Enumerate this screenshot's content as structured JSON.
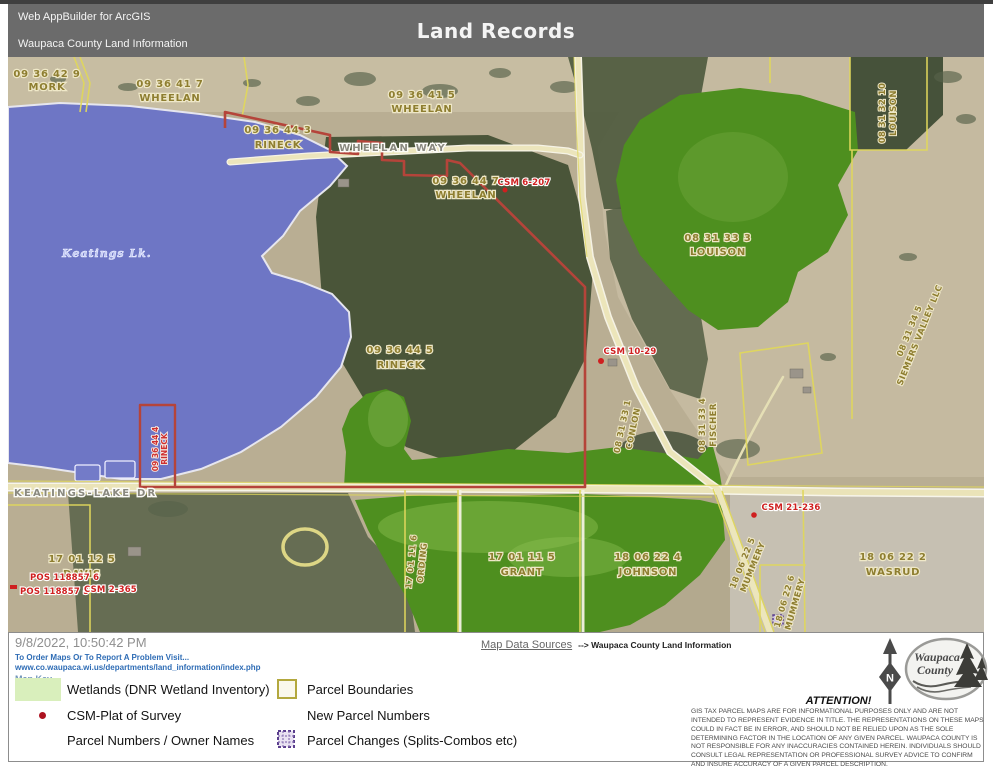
{
  "header": {
    "app": "Web AppBuilder for ArcGIS",
    "org": "Waupaca County Land Information",
    "title": "Land Records"
  },
  "map": {
    "lake_label": "Keatings Lk.",
    "roads": {
      "wheelan_way": "WHEELAN WAY",
      "keatings_lake_dr": "KEATINGS-LAKE DR"
    },
    "parcels": {
      "mork": {
        "id": "09 36 42 9",
        "name": "MORK"
      },
      "wheelan7": {
        "id": "09 36 41 7",
        "name": "WHEELAN"
      },
      "wheelan5": {
        "id": "09 36 41 5",
        "name": "WHEELAN"
      },
      "rineck3": {
        "id": "09 36 44 3",
        "name": "RINECK"
      },
      "wheelan447": {
        "id": "09 36 44 7",
        "name": "WHEELAN"
      },
      "louison33": {
        "id": "08 31 33 3",
        "name": "LOUISON"
      },
      "louison32": {
        "id": "08 31 32 10",
        "name": "LOUISON"
      },
      "siemers": {
        "id": "08 31 34 5",
        "name": "SIEMERS VALLEY LLC"
      },
      "rineck5": {
        "id": "09 36 44 5",
        "name": "RINECK"
      },
      "conlon": {
        "id": "08 31 33 1",
        "name": "CONLON"
      },
      "fischer": {
        "id": "08 31 33 4",
        "name": "FISCHER"
      },
      "rineck4": {
        "id": "09 36 44 4",
        "name": "RINECK"
      },
      "davis": {
        "id": "17 01 12 5",
        "name": "DAVIS"
      },
      "ording": {
        "id": "17 01 11 6",
        "name": "ORDING"
      },
      "grant": {
        "id": "17 01 11 5",
        "name": "GRANT"
      },
      "johnson": {
        "id": "18 06 22 4",
        "name": "JOHNSON"
      },
      "mummery5": {
        "id": "18 06 22 5",
        "name": "MUMMERY"
      },
      "mummery6": {
        "id": "18 06 22 6",
        "name": "MUMMERY"
      },
      "wasrud": {
        "id": "18 06 22 2",
        "name": "WASRUD"
      }
    },
    "surveys": {
      "csm6207": "CSM 6-207",
      "csm1029": "CSM 10-29",
      "csm21236": "CSM 21-236",
      "pos6": "POS 118857 6",
      "pos5": "POS 118857 5",
      "csm2365": "CSM 2-365"
    }
  },
  "footer": {
    "timestamp": "9/8/2022, 10:50:42 PM",
    "order_line1": "To Order Maps Or To Report A Problem Visit...",
    "order_line2": "www.co.waupaca.wi.us/departments/land_information/index.php",
    "map_key_label": "Map Key",
    "legend": {
      "wetlands": "Wetlands (DNR Wetland Inventory)",
      "parcel_boundaries": "Parcel Boundaries",
      "csm_plat": "CSM-Plat of Survey",
      "new_parcel_numbers": "New Parcel Numbers",
      "parcel_numbers": "Parcel Numbers / Owner Names",
      "parcel_changes": "Parcel Changes (Splits-Combos etc)"
    },
    "data_sources_label": "Map Data Sources",
    "data_sources_value": "--> Waupaca County Land Information",
    "attention_title": "ATTENTION!",
    "attention_text": "GIS TAX PARCEL MAPS ARE FOR INFORMATIONAL PURPOSES ONLY AND ARE NOT INTENDED TO REPRESENT EVIDENCE IN TITLE. THE REPRESENTATIONS ON THESE MAPS COULD IN FACT BE IN ERROR, AND SHOULD NOT BE RELIED UPON AS THE SOLE DETERMINING FACTOR IN THE LOCATION OF ANY GIVEN PARCEL. WAUPACA COUNTY IS NOT RESPONSIBLE FOR ANY INACCURACIES CONTAINED HEREIN. INDIVIDUALS SHOULD CONSULT LEGAL REPRESENTATION OR PROFESSIONAL SURVEY ADVICE TO CONFIRM AND INSURE ACCURACY OF A GIVEN PARCEL DESCRIPTION.",
    "logo_line1": "Waupaca",
    "logo_line2": "County",
    "north_label": "N"
  },
  "colors": {
    "header_bg": "#6b6b6b",
    "lake_blue": "#6e76c5",
    "wetland_green": "#4e8f1f",
    "parcel_line_yellow": "#e0d75c",
    "selected_parcel_red": "#b5443a",
    "survey_red": "#cf1f1f",
    "link_blue": "#2e6cb5",
    "legend_wetland_swatch": "#d9efbc",
    "parcel_change_purple": "#5b3f8e"
  }
}
